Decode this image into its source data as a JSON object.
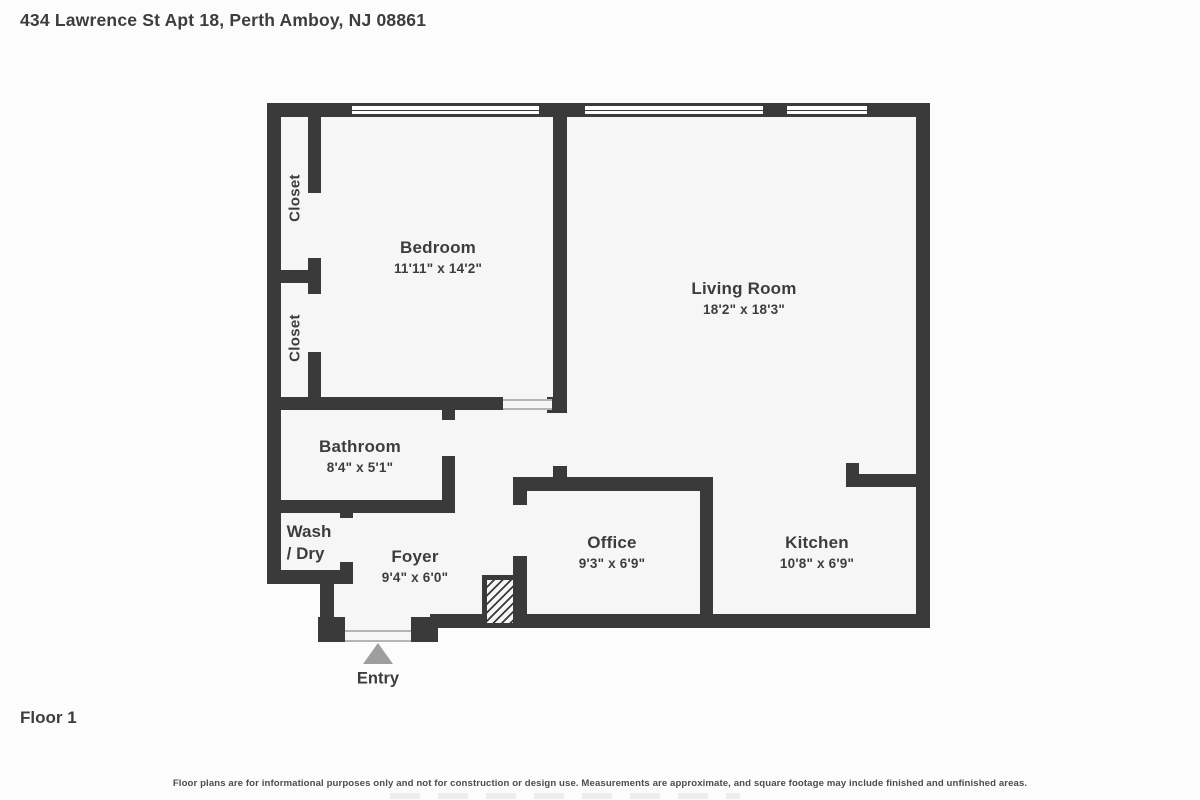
{
  "header": {
    "address": "434 Lawrence St Apt 18, Perth Amboy, NJ 08861"
  },
  "footer": {
    "floor_label": "Floor 1",
    "disclaimer": "Floor plans are for informational purposes only and not for construction or design use. Measurements are approximate, and square footage may include finished and unfinished areas."
  },
  "plan": {
    "entry_label": "Entry",
    "rooms": {
      "bedroom": {
        "name": "Bedroom",
        "dims": "11'11\" x 14'2\""
      },
      "living_room": {
        "name": "Living Room",
        "dims": "18'2\" x 18'3\""
      },
      "bathroom": {
        "name": "Bathroom",
        "dims": "8'4\" x 5'1\""
      },
      "foyer": {
        "name": "Foyer",
        "dims": "9'4\" x 6'0\""
      },
      "office": {
        "name": "Office",
        "dims": "9'3\" x 6'9\""
      },
      "kitchen": {
        "name": "Kitchen",
        "dims": "10'8\" x 6'9\""
      },
      "closet_upper": {
        "name": "Closet"
      },
      "closet_lower": {
        "name": "Closet"
      },
      "wash_dry": {
        "line1": "Wash",
        "line2": "/ Dry"
      }
    }
  },
  "colors": {
    "wall": "#3a3a3a",
    "floor": "#f6f6f6",
    "page-bg": "#fcfcfc",
    "text": "#3d3d3d",
    "entry-arrow": "#9e9e9e",
    "disclaimer-text": "#4d4d4d"
  }
}
